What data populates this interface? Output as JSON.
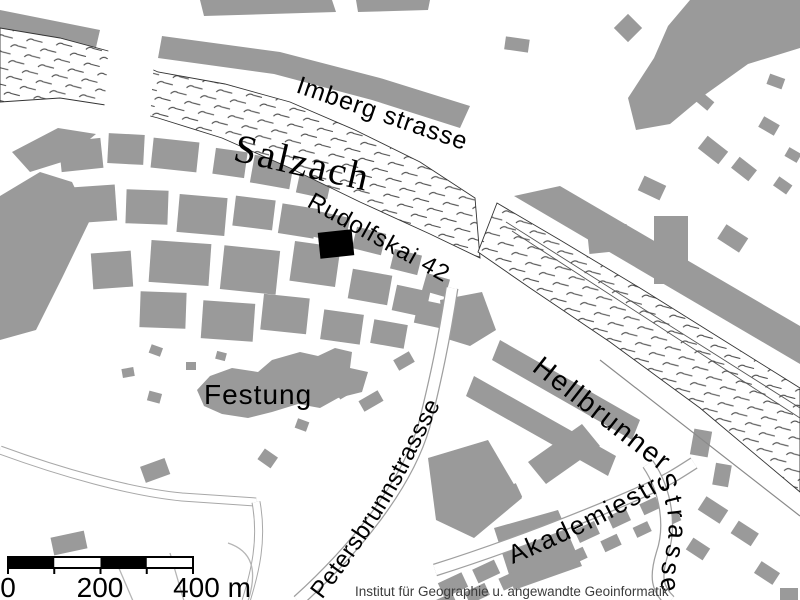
{
  "map": {
    "labels": {
      "river": "Salzach",
      "imbergstrasse": "Imberg strasse",
      "rudolfskai": "Rudolfskai 42",
      "festung": "Festung",
      "hellbrunner": "Hellbrunner",
      "hellbrunner_strasse": "Strasse",
      "petersbrunnstrasse": "Petersbrunnstrassse",
      "akademiestrasse": "Akademiestr."
    },
    "scale_bar": {
      "tick_start": "0",
      "tick_middle": "200",
      "tick_end": "400 m"
    },
    "attribution": "Institut für Geographie u. angewandte Geoinformatik",
    "colors": {
      "building": "#9a9a9a",
      "water_mark": "#4a4a4a",
      "highlight": "#000000",
      "background": "#ffffff",
      "river_outline": "#333333"
    }
  }
}
